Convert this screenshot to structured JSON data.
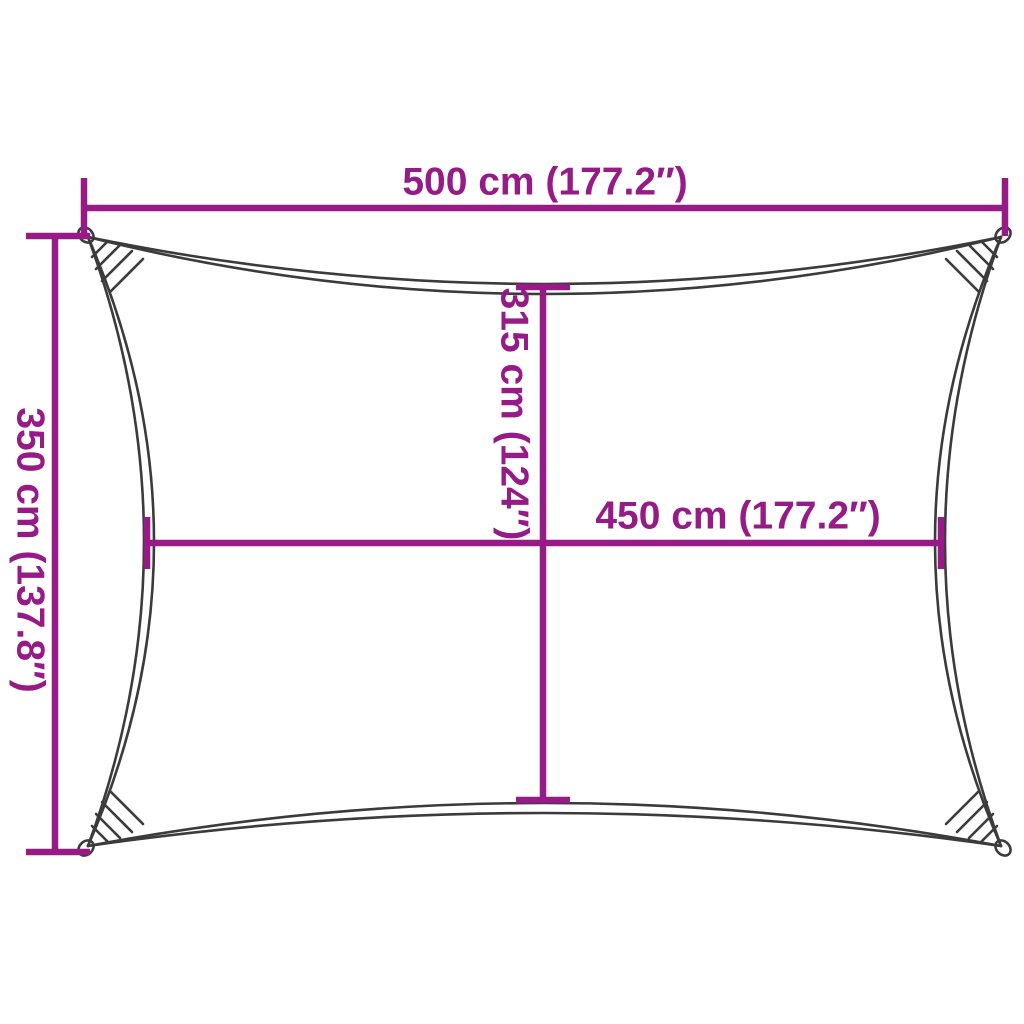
{
  "diagram": {
    "type": "product-dimension-diagram",
    "subject": "rectangular-shade-sail",
    "labels": {
      "top_width": "500 cm (177.2″)",
      "left_height": "350 cm (137.8″)",
      "center_height": "315 cm (124″)",
      "center_width": "450 cm (177.2″)"
    }
  },
  "colors": {
    "dimension_accent": "#961b87",
    "sail_outline": "#3b3b3b",
    "background": "#ffffff"
  }
}
